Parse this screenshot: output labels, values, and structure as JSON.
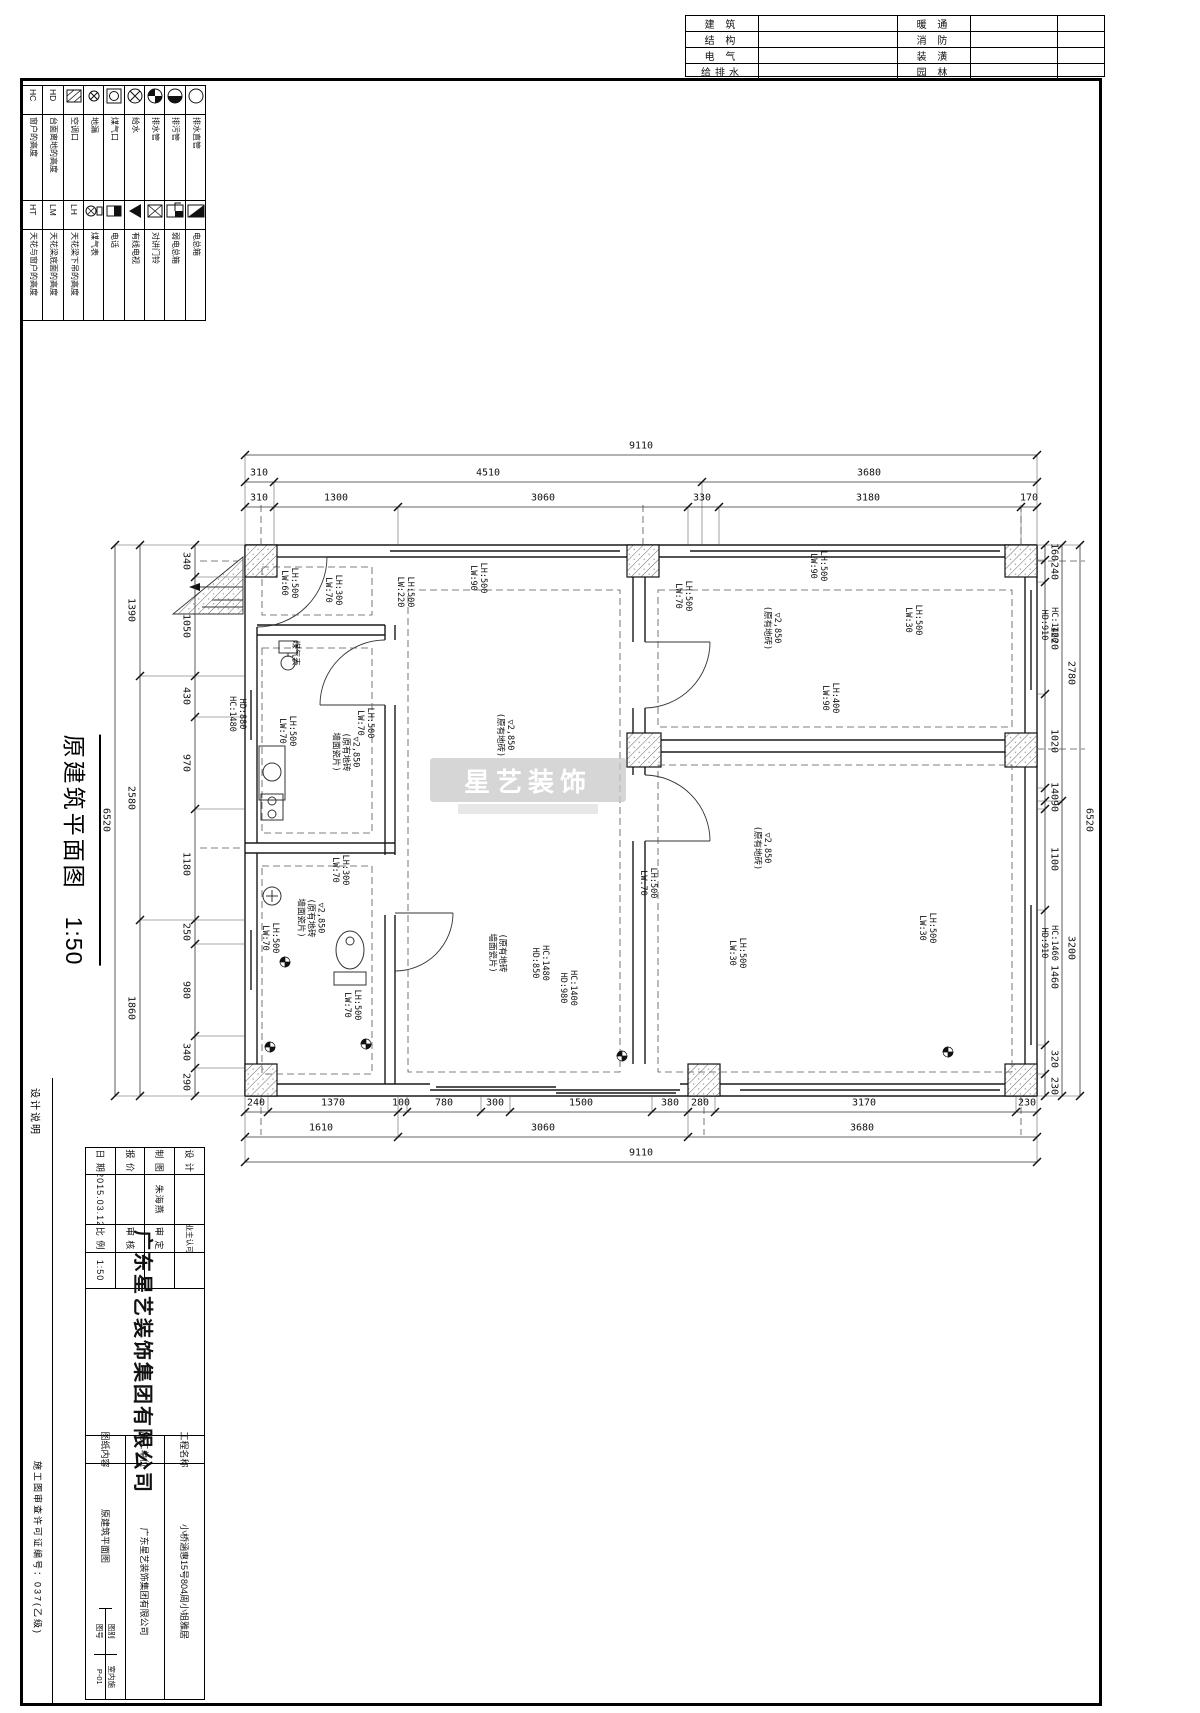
{
  "header_table": {
    "rows": [
      [
        "建 筑",
        "暖 通"
      ],
      [
        "结 构",
        "消 防"
      ],
      [
        "电 气",
        "装 潢"
      ],
      [
        "给排水",
        "园 林"
      ]
    ]
  },
  "legend": {
    "cols": [
      {
        "top": {
          "code": "HC",
          "label": "窗户的高度"
        },
        "bottom": {
          "code": "HT",
          "label": "天花与窗户的高度"
        }
      },
      {
        "top": {
          "code": "HD",
          "label": "台面离地的高度"
        },
        "bottom": {
          "code": "LM",
          "label": "天花梁底面的高度"
        }
      },
      {
        "top": {
          "icon": "ac",
          "label": "空调口"
        },
        "bottom": {
          "code": "LH",
          "label": "天花梁下吊的高度"
        }
      },
      {
        "top": {
          "icon": "drain",
          "label": "地漏"
        },
        "bottom": {
          "icon": "gasmeter",
          "label": "煤气表"
        }
      },
      {
        "top": {
          "icon": "gasport",
          "label": "煤气口"
        },
        "bottom": {
          "icon": "phone",
          "label": "电话"
        }
      },
      {
        "top": {
          "icon": "water",
          "label": "给水"
        },
        "bottom": {
          "icon": "tv",
          "label": "有线电视"
        }
      },
      {
        "top": {
          "icon": "pipe4",
          "label": "排水管"
        },
        "bottom": {
          "icon": "doorbell",
          "label": "对讲门铃"
        }
      },
      {
        "top": {
          "icon": "sewage",
          "label": "排污管"
        },
        "bottom": {
          "icon": "weakbox",
          "label": "弱电总箱"
        }
      },
      {
        "top": {
          "icon": "vpipe",
          "label": "排水直管"
        },
        "bottom": {
          "icon": "powerbox",
          "label": "电总箱"
        }
      }
    ]
  },
  "plan_title": {
    "text": "原建筑平面图",
    "scale": "1:50"
  },
  "watermark": {
    "text": "星艺装饰"
  },
  "plan": {
    "top": 545,
    "bottom": 1096,
    "left": 245,
    "right": 1037
  },
  "dim_chains": [
    {
      "o": "h",
      "p": 455,
      "a": 245,
      "b": 1037,
      "ticks": [
        245,
        1037
      ],
      "texts": [
        {
          "t": "9110",
          "x": 641
        }
      ]
    },
    {
      "o": "h",
      "p": 482,
      "a": 245,
      "b": 1037,
      "ticks": [
        245,
        274,
        702,
        1037
      ],
      "texts": [
        {
          "t": "310",
          "x": 259
        },
        {
          "t": "4510",
          "x": 488
        },
        {
          "t": "3680",
          "x": 869
        }
      ]
    },
    {
      "o": "h",
      "p": 507,
      "a": 245,
      "b": 1037,
      "ticks": [
        245,
        274,
        398,
        688,
        719,
        1021,
        1037
      ],
      "texts": [
        {
          "t": "310",
          "x": 259
        },
        {
          "t": "1300",
          "x": 336
        },
        {
          "t": "3060",
          "x": 543
        },
        {
          "t": "330",
          "x": 702
        },
        {
          "t": "3180",
          "x": 868
        },
        {
          "t": "170",
          "x": 1029
        }
      ]
    },
    {
      "o": "h",
      "p": 1112,
      "a": 245,
      "b": 1037,
      "ticks": [
        245,
        268,
        398,
        407,
        481,
        510,
        652,
        688,
        715,
        1016,
        1037
      ],
      "texts": [
        {
          "t": "240",
          "x": 256
        },
        {
          "t": "1370",
          "x": 333
        },
        {
          "t": "100",
          "x": 401
        },
        {
          "t": "780",
          "x": 444
        },
        {
          "t": "300",
          "x": 495
        },
        {
          "t": "1500",
          "x": 581
        },
        {
          "t": "380",
          "x": 670
        },
        {
          "t": "280",
          "x": 700
        },
        {
          "t": "3170",
          "x": 864
        },
        {
          "t": "230",
          "x": 1027
        }
      ]
    },
    {
      "o": "h",
      "p": 1137,
      "a": 245,
      "b": 1037,
      "ticks": [
        245,
        398,
        688,
        1037
      ],
      "texts": [
        {
          "t": "1610",
          "x": 321
        },
        {
          "t": "3060",
          "x": 543
        },
        {
          "t": "3680",
          "x": 862
        }
      ]
    },
    {
      "o": "h",
      "p": 1162,
      "a": 245,
      "b": 1037,
      "ticks": [
        245,
        1037
      ],
      "texts": [
        {
          "t": "9110",
          "x": 641
        }
      ]
    },
    {
      "o": "v",
      "p": 195,
      "a": 545,
      "b": 1096,
      "ticks": [
        545,
        577,
        676,
        717,
        809,
        920,
        944,
        1036,
        1068,
        1096
      ],
      "texts": [
        {
          "t": "340",
          "y": 561
        },
        {
          "t": "1050",
          "y": 626
        },
        {
          "t": "430",
          "y": 696
        },
        {
          "t": "970",
          "y": 763
        },
        {
          "t": "1180",
          "y": 864
        },
        {
          "t": "250",
          "y": 932
        },
        {
          "t": "980",
          "y": 990
        },
        {
          "t": "340",
          "y": 1052
        },
        {
          "t": "290",
          "y": 1082
        }
      ]
    },
    {
      "o": "v",
      "p": 140,
      "a": 545,
      "b": 1096,
      "ticks": [
        545,
        676,
        920,
        1096
      ],
      "texts": [
        {
          "t": "1390",
          "y": 610
        },
        {
          "t": "2580",
          "y": 798
        },
        {
          "t": "1860",
          "y": 1008
        }
      ]
    },
    {
      "o": "v",
      "p": 115,
      "a": 545,
      "b": 1096,
      "ticks": [
        545,
        1096
      ],
      "texts": [
        {
          "t": "6520",
          "y": 820
        }
      ]
    },
    {
      "o": "v",
      "p": 1045,
      "a": 545,
      "b": 1096,
      "ticks": [
        545,
        560,
        582,
        694,
        788,
        801,
        809,
        910,
        1045,
        1074,
        1096
      ],
      "texts": [
        {
          "t": "160",
          "y": 552
        },
        {
          "t": "240",
          "y": 571
        },
        {
          "t": "1220",
          "y": 638
        },
        {
          "t": "1020",
          "y": 741
        },
        {
          "t": "140",
          "y": 791
        },
        {
          "t": "90",
          "y": 806
        },
        {
          "t": "1100",
          "y": 859
        },
        {
          "t": "1460",
          "y": 977
        },
        {
          "t": "320",
          "y": 1059
        },
        {
          "t": "230",
          "y": 1086
        }
      ]
    },
    {
      "o": "v",
      "p": 1062,
      "a": 545,
      "b": 1096,
      "ticks": [
        545,
        801,
        1096
      ],
      "texts": [
        {
          "t": "2780",
          "y": 673
        },
        {
          "t": "3200",
          "y": 948
        }
      ]
    },
    {
      "o": "v",
      "p": 1080,
      "a": 545,
      "b": 1096,
      "ticks": [
        545,
        1096
      ],
      "texts": [
        {
          "t": "6520",
          "y": 820
        }
      ]
    }
  ],
  "plan_labels": [
    {
      "x": 289,
      "y": 583,
      "l": [
        "LH:500",
        "LW:60"
      ]
    },
    {
      "x": 333,
      "y": 590,
      "l": [
        "LH:300",
        "LW:70"
      ]
    },
    {
      "x": 405,
      "y": 592,
      "l": [
        "LH:500",
        "LW:220"
      ]
    },
    {
      "x": 478,
      "y": 578,
      "l": [
        "LH:500",
        "LW:90"
      ]
    },
    {
      "x": 683,
      "y": 596,
      "l": [
        "LH:500",
        "LW:70"
      ]
    },
    {
      "x": 818,
      "y": 566,
      "l": [
        "LH:500",
        "LW:90"
      ]
    },
    {
      "x": 913,
      "y": 620,
      "l": [
        "LH:500",
        "LW:30"
      ]
    },
    {
      "x": 1049,
      "y": 625,
      "l": [
        "HC:1460",
        "HD:910"
      ]
    },
    {
      "x": 830,
      "y": 698,
      "l": [
        "LH:400",
        "LW:90"
      ]
    },
    {
      "x": 237,
      "y": 714,
      "l": [
        "HD:880",
        "HC:1480"
      ]
    },
    {
      "x": 365,
      "y": 723,
      "l": [
        "LH:500",
        "LW:70"
      ]
    },
    {
      "x": 287,
      "y": 731,
      "l": [
        "LH:500",
        "LW:70"
      ]
    },
    {
      "x": 345,
      "y": 752,
      "l": [
        "▽2,850",
        "(原有地砖",
        "墙面瓷片)"
      ]
    },
    {
      "x": 505,
      "y": 735,
      "l": [
        "▽2,850",
        "(原有地砖)"
      ]
    },
    {
      "x": 772,
      "y": 628,
      "l": [
        "▽2,850",
        "(原有地砖)"
      ]
    },
    {
      "x": 762,
      "y": 848,
      "l": [
        "▽2,850",
        "(原有地砖)"
      ]
    },
    {
      "x": 310,
      "y": 918,
      "l": [
        "▽2,850",
        "(原有地砖",
        "墙面瓷片)"
      ]
    },
    {
      "x": 340,
      "y": 870,
      "l": [
        "LH:300",
        "LW:70"
      ]
    },
    {
      "x": 270,
      "y": 938,
      "l": [
        "LH:500",
        "LW:70"
      ]
    },
    {
      "x": 352,
      "y": 1005,
      "l": [
        "LH:500",
        "LW:70"
      ]
    },
    {
      "x": 497,
      "y": 953,
      "l": [
        "(原有地砖",
        "墙面瓷片)"
      ]
    },
    {
      "x": 540,
      "y": 963,
      "l": [
        "HC:1480",
        "HD:850"
      ]
    },
    {
      "x": 568,
      "y": 988,
      "l": [
        "HC:1400",
        "HD:980"
      ]
    },
    {
      "x": 648,
      "y": 883,
      "l": [
        "LH:500",
        "LW:70"
      ]
    },
    {
      "x": 737,
      "y": 953,
      "l": [
        "LH:500",
        "LW:30"
      ]
    },
    {
      "x": 927,
      "y": 928,
      "l": [
        "LH:500",
        "LW:30"
      ]
    },
    {
      "x": 1049,
      "y": 943,
      "l": [
        "HC:1460",
        "HD:910"
      ]
    },
    {
      "x": 295,
      "y": 653,
      "l": [
        "煤气表"
      ]
    }
  ],
  "title_block": {
    "design_label": "设 计",
    "design_value": "",
    "draft_label": "制 图",
    "draft_value": "朱海燕",
    "quote_label": "报 价",
    "quote_value": "",
    "date_label": "日 期",
    "date_value": "2015.03.12",
    "owner_label": "业主认可",
    "owner_value": "",
    "review_label": "审 定",
    "review_value": "",
    "audit_label": "审 核",
    "audit_value": "",
    "scale_label": "比 例",
    "scale_value": "1:50",
    "company": "广东星艺装饰集团有限公司",
    "project_label": "工程名称",
    "project_value": "小桥涵惠15号804周小姐雅居",
    "builder_label": "施工单位",
    "builder_value": "广东星艺装饰集团有限公司",
    "content_label": "图纸内容",
    "content_value": "原建筑平面图",
    "cat_label": "图别",
    "cat_value": "室内施",
    "no_label": "图号",
    "no_value": "P-01"
  },
  "footer": {
    "left": "设计说明",
    "right": "施工图审查许可证编号：037(乙级)"
  }
}
